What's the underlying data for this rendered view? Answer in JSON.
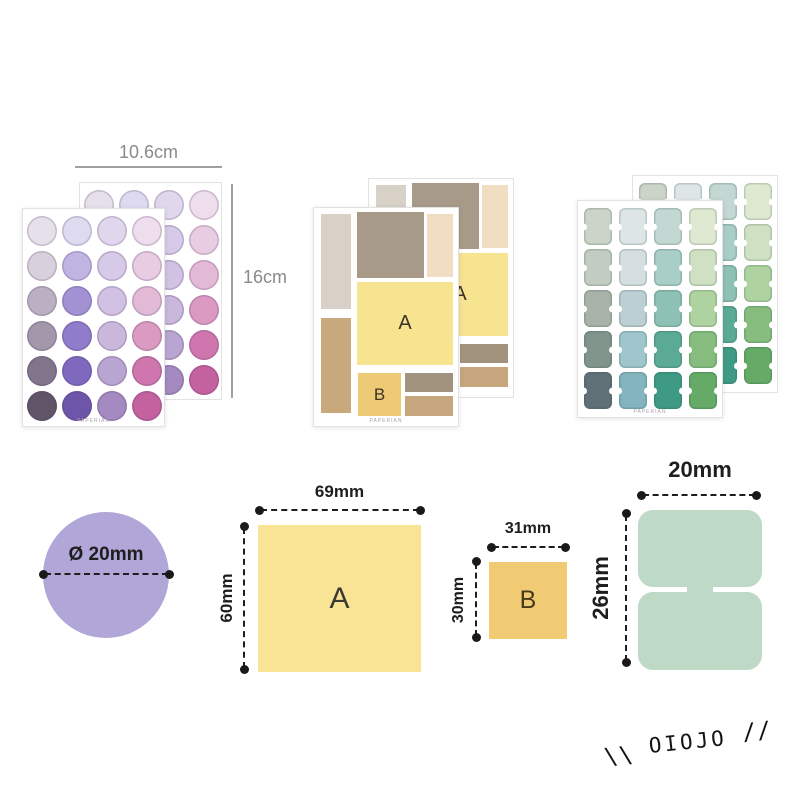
{
  "brand": {
    "watermark": "OIOJO",
    "watermark_left_slashes": "\\\\",
    "watermark_right_slashes": "//",
    "sheet_footer": "PAPERIAN"
  },
  "dims": {
    "sheet_width": "10.6cm",
    "sheet_height": "16cm"
  },
  "purple_sheet": {
    "rows": 6,
    "cols": 4,
    "colors": [
      [
        "#e6e0ea",
        "#dedaf0",
        "#e0d7ed",
        "#eedded"
      ],
      [
        "#d8d0dd",
        "#c0b4e2",
        "#d6cae8",
        "#e8cce1"
      ],
      [
        "#bbb0c2",
        "#a292d4",
        "#d1c2e4",
        "#e2bad6"
      ],
      [
        "#a397ac",
        "#8f7cca",
        "#c9b8dc",
        "#db9ac2"
      ],
      [
        "#81758b",
        "#7e69bf",
        "#b9a5d1",
        "#ce76ad"
      ],
      [
        "#5f5567",
        "#6d55aa",
        "#a48ac1",
        "#c4619f"
      ]
    ]
  },
  "mixed_sheet": {
    "blocks": [
      {
        "id": "tl",
        "color": "#d7d1c7",
        "label": ""
      },
      {
        "id": "tc",
        "color": "#a79a88",
        "label": ""
      },
      {
        "id": "tr",
        "color": "#f0ddc2",
        "label": ""
      },
      {
        "id": "a",
        "color": "#f7e491",
        "label": "A"
      },
      {
        "id": "bl",
        "color": "#c9a87e",
        "label": ""
      },
      {
        "id": "b",
        "color": "#eeca77",
        "label": "B"
      },
      {
        "id": "r1",
        "color": "#a2937e",
        "label": ""
      },
      {
        "id": "r2",
        "color": "#c5a67d",
        "label": ""
      }
    ]
  },
  "green_sheet": {
    "rows": 5,
    "cols": 4,
    "colors": [
      [
        "#ccd3c8",
        "#dde5e7",
        "#c3d7d3",
        "#dfe9d1"
      ],
      [
        "#c2ccc2",
        "#d5dfe2",
        "#a9cdc7",
        "#d0e1c3"
      ],
      [
        "#a8b2a9",
        "#bccfd4",
        "#8ec1b5",
        "#aed2a0"
      ],
      [
        "#81948b",
        "#9fc6cd",
        "#5aaa96",
        "#86bd7e"
      ],
      [
        "#5f7077",
        "#82b5be",
        "#3f9a85",
        "#65aa67"
      ]
    ]
  },
  "specs": {
    "circle": {
      "diameter_label": "Ø 20mm",
      "color": "#b1a6d8"
    },
    "a": {
      "label": "A",
      "width": "69mm",
      "height": "60mm",
      "color": "#f8e494"
    },
    "b": {
      "label": "B",
      "width": "31mm",
      "height": "30mm",
      "color": "#f1ca74"
    },
    "tab": {
      "width": "20mm",
      "height": "26mm",
      "color": "#bedac7"
    }
  }
}
